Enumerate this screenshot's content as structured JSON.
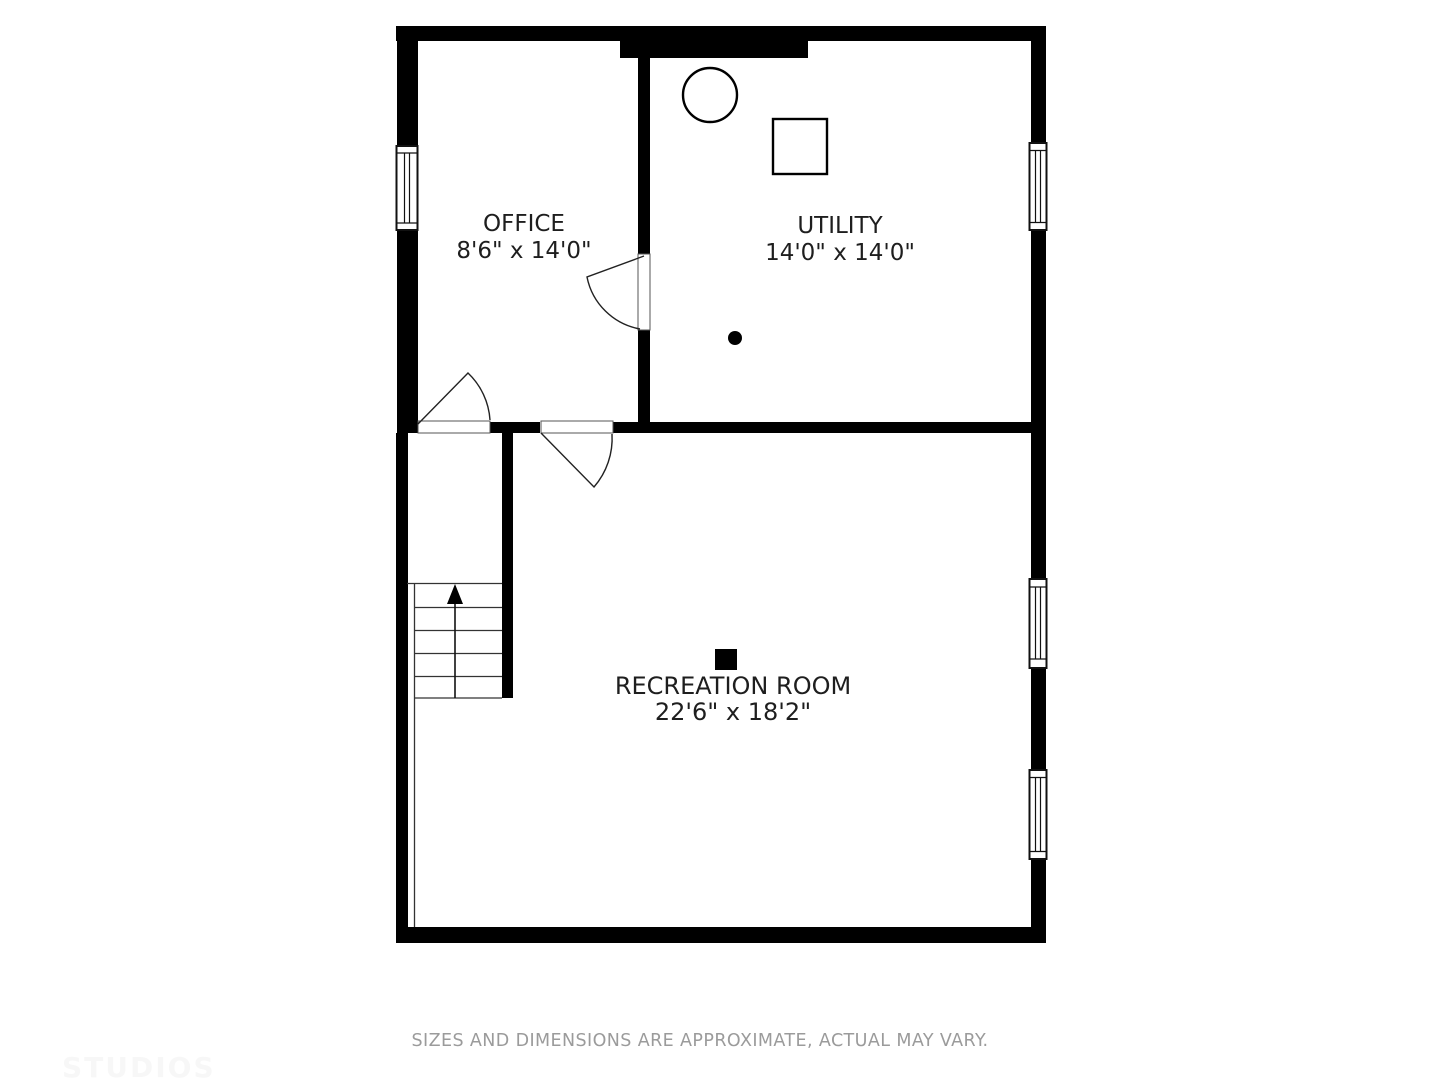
{
  "floorplan": {
    "title": "basement floor plan",
    "rooms": [
      {
        "id": "office",
        "name": "OFFICE",
        "dimensions": "8'6\" x 14'0\""
      },
      {
        "id": "utility",
        "name": "UTILITY",
        "dimensions": "14'0\" x 14'0\""
      },
      {
        "id": "recreation",
        "name": "RECREATION ROOM",
        "dimensions": "22'6\" x 18'2\""
      }
    ],
    "fixtures": [
      {
        "id": "water-heater",
        "shape": "circle-outline",
        "room": "utility"
      },
      {
        "id": "furnace",
        "shape": "square-outline",
        "room": "utility"
      },
      {
        "id": "floor-drain",
        "shape": "filled-dot",
        "room": "utility"
      },
      {
        "id": "support-post",
        "shape": "filled-square",
        "room": "recreation"
      }
    ],
    "stairs": {
      "direction": "up",
      "steps": 5
    },
    "windows_count": 4,
    "doors_count": 3,
    "colors": {
      "wall": "#000000",
      "line": "#2a2a2a",
      "label_text": "#1e1e1e",
      "footer_text": "#9b9b9b",
      "watermark_text": "#f7f7f7",
      "background": "#ffffff"
    }
  },
  "footer": {
    "disclaimer": "SIZES AND DIMENSIONS ARE APPROXIMATE, ACTUAL MAY VARY."
  },
  "watermark": {
    "text": "STUDIOS"
  }
}
